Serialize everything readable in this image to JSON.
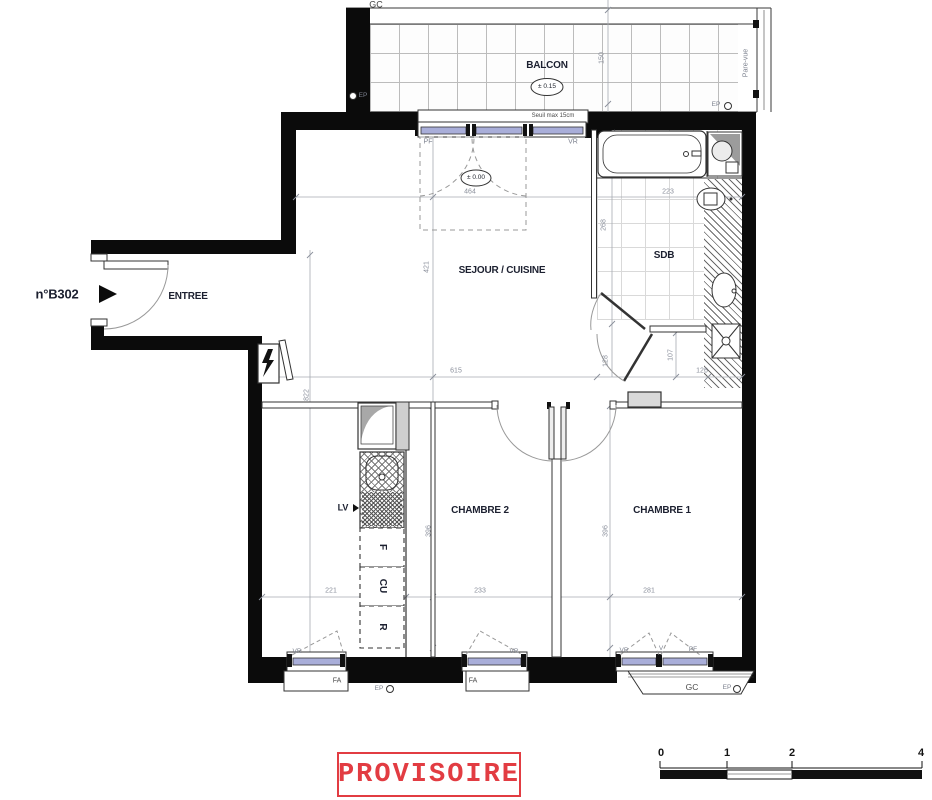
{
  "plan": {
    "unit": "n°B302",
    "stamp": "PROVISOIRE",
    "rooms": {
      "balcony": "BALCON",
      "living": "SEJOUR / CUISINE",
      "bathroom": "SDB",
      "entry": "ENTREE",
      "bedroom2": "CHAMBRE 2",
      "bedroom1": "CHAMBRE 1"
    },
    "levels": {
      "balcony": "± 0.15",
      "floor": "± 0.00"
    },
    "notes": {
      "seuil": "Seuil max 15cm",
      "pare_vue": "Pare-vue"
    },
    "equipment": {
      "lv": "LV",
      "f": "F",
      "cu": "CU",
      "r": "R"
    },
    "tags": {
      "gc": "GC",
      "ep": "EP",
      "pf": "PF",
      "vr": "VR",
      "fa": "FA",
      "v": "V"
    },
    "dims": {
      "balcony_depth": "150",
      "bay_width": "464",
      "living_depth": "421",
      "living_width": "615",
      "total_depth": "822",
      "sdb_depth": "268",
      "sdb_width": "223",
      "hall_depth": "128",
      "wc_depth": "107",
      "wc_width": "126",
      "kitchen_width": "221",
      "bedroom2_width": "233",
      "bedroom1_width": "281",
      "bedroom2_depth": "396",
      "bedroom1_depth": "396"
    }
  },
  "scale_bar": {
    "labels": [
      "0",
      "1",
      "2",
      "4"
    ]
  }
}
